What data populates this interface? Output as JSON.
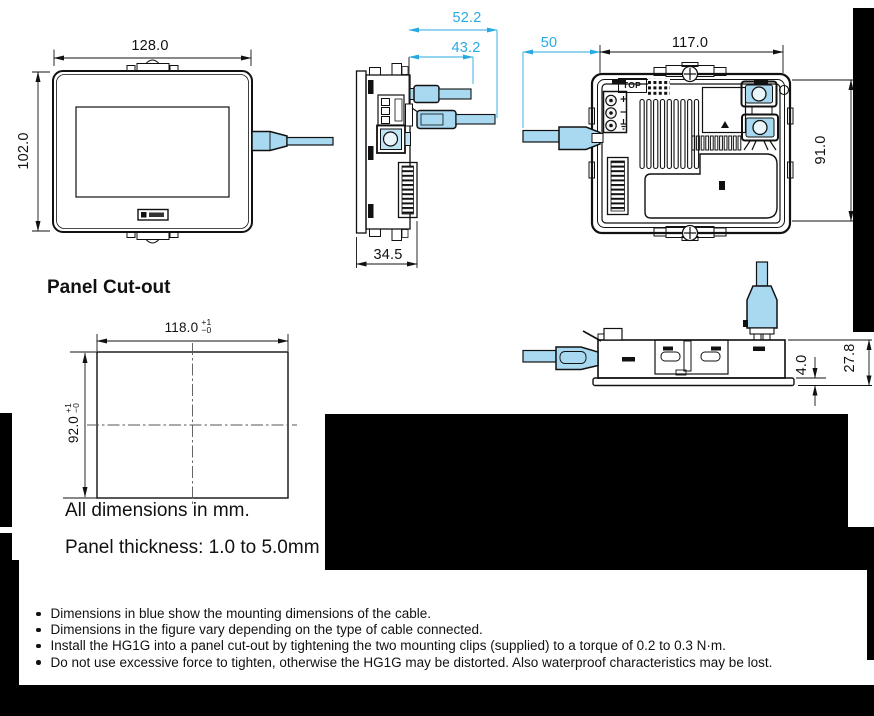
{
  "palette": {
    "dimension_blue": "#29a9e1",
    "cable_fill": "#a8d9f0",
    "line_black": "#111111"
  },
  "views": {
    "front": {
      "width": "128.0",
      "height": "102.0"
    },
    "side": {
      "cable_outer": "52.2",
      "cable_inner": "43.2",
      "depth": "34.5"
    },
    "rear": {
      "cable_left": "50",
      "width": "117.0",
      "height": "91.0",
      "top_label": "TOP"
    },
    "bottom": {
      "bezel_lip": "4.0",
      "depth_behind_panel": "27.8"
    }
  },
  "cutout": {
    "heading": "Panel Cut-out",
    "width": {
      "value": "118.0",
      "tol_plus": "+1",
      "tol_minus": "−0"
    },
    "height": {
      "value": "92.0",
      "tol_plus": "+1",
      "tol_minus": "−0"
    },
    "note_units": "All dimensions in mm.",
    "note_thickness": "Panel thickness: 1.0 to 5.0mm"
  },
  "notes": {
    "bullets": [
      "Dimensions in blue show the mounting dimensions of the cable.",
      "Dimensions in the figure vary depending on the type of cable connected.",
      "Install the HG1G into a panel cut-out by tightening the two mounting clips (supplied) to a torque of 0.2 to 0.3 N·m.",
      "Do not use excessive force to tighten, otherwise the HG1G may be distorted. Also waterproof characteristics may be lost."
    ]
  }
}
